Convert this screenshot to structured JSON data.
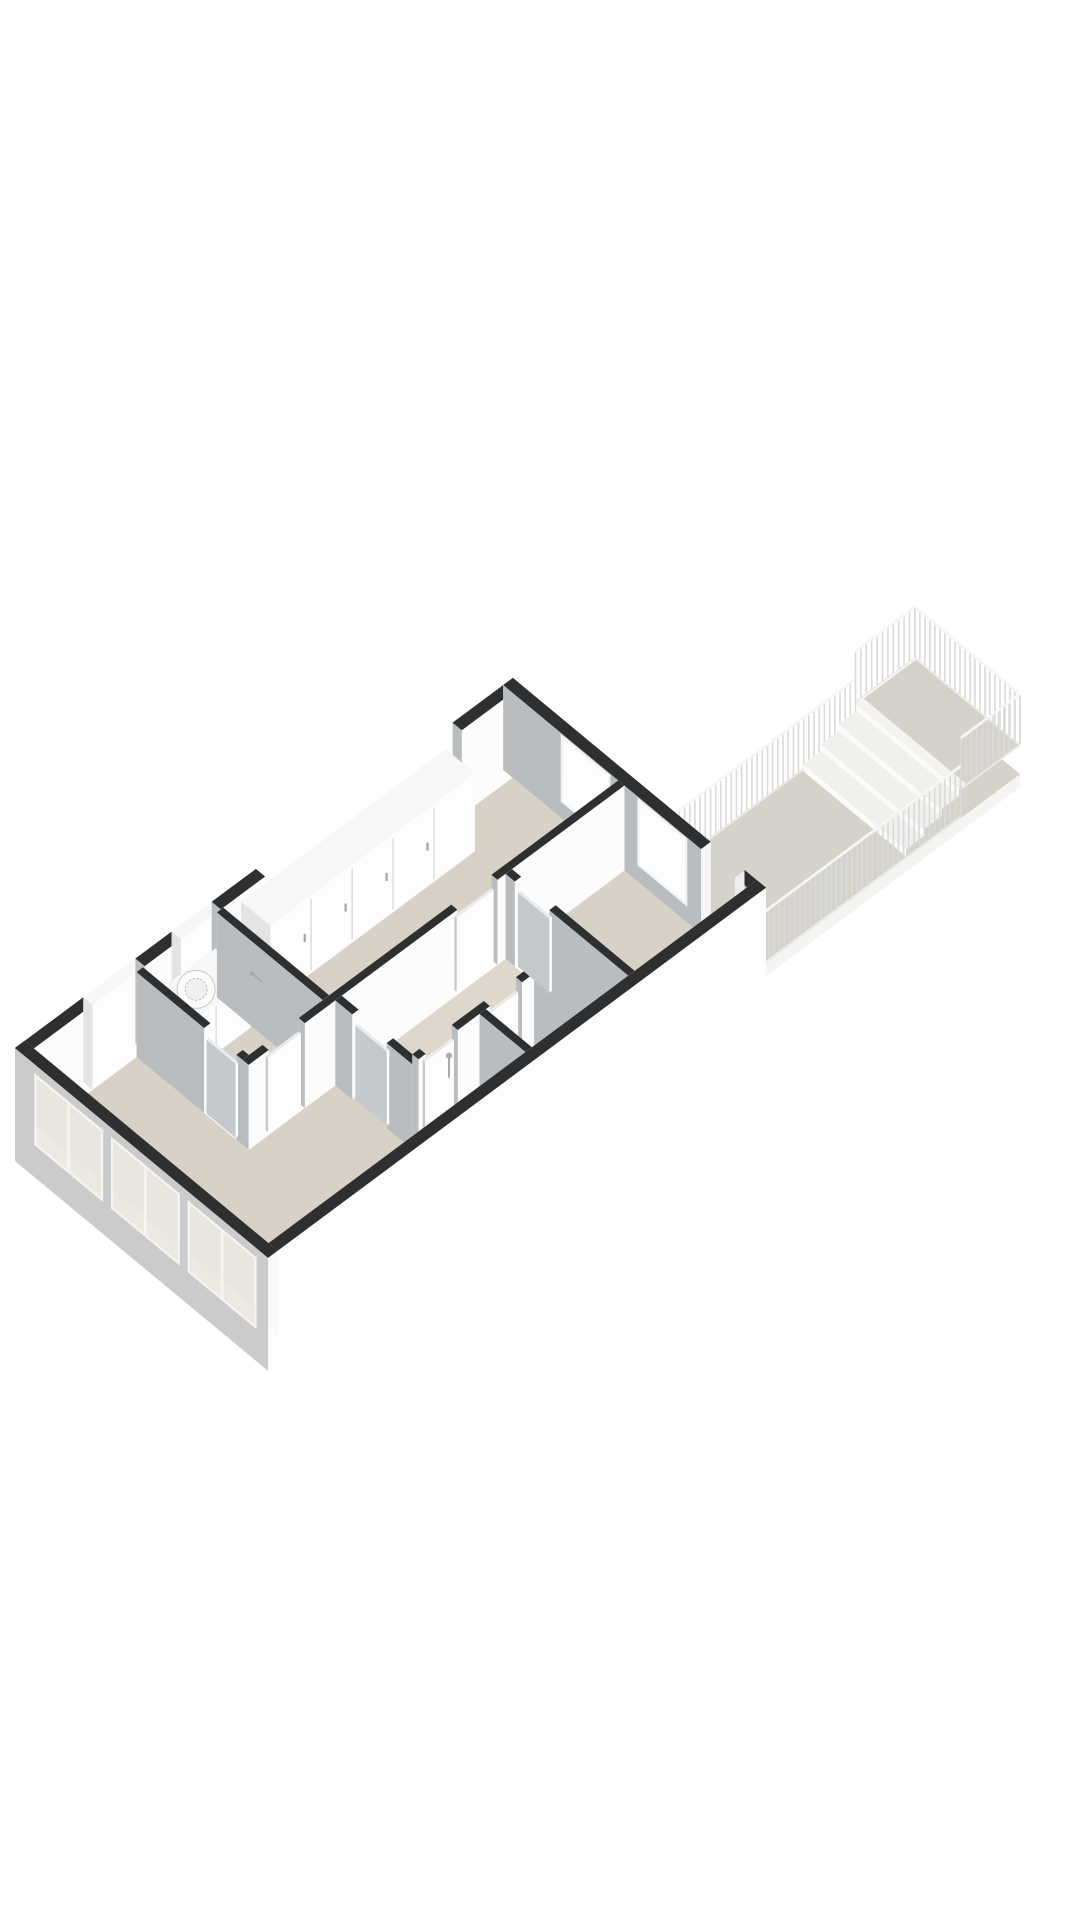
{
  "scene": {
    "type": "3d-floor-plan-render",
    "description": "Axonometric cutaway 3D floor plan of an apartment viewed from the south-west, with dark cut wall tops, beige floors, facade windows, and an exterior access walkway with white baluster railings and three steps up to a raised landing",
    "background": "#ffffff"
  },
  "colors": {
    "wall_top": "#2e2f30",
    "wall_face_sw": "#fcfcfc",
    "wall_face_nw": "#f3f3f2",
    "wall_face_gray": "#b9bdc0",
    "wall_face_ne": "#eaeaec",
    "facade": "#c9cbcc",
    "floor": "#d8d1c5",
    "floor_hall": "#ddd7cc",
    "floor_bath": "#e1ded7",
    "walk_floor": "#d5d2c9",
    "glass": "#e9e6e0",
    "glass_bright": "#fdfdfe",
    "frame": "#f4f4f3",
    "win_panel": "#ece9e2",
    "rail_top": "#f6f6f6",
    "rail_base": "#ebebea",
    "rail_baluster": "#d8dadb",
    "step": "#f1f0ed",
    "riser": "#fbfbfa",
    "top_white": "#f7f7f7",
    "door_top": "#ebebeb",
    "handle": "#a0a4a7",
    "fixture": "#a8abad",
    "slab": "#fdfdfd"
  },
  "building": {
    "name": "apartment",
    "facade_window_count": 3,
    "rear_window_count": 2,
    "rooms": [
      "living-room",
      "kitchen",
      "bedroom-1",
      "bedroom-2",
      "hallway",
      "bathroom",
      "toilet",
      "storage"
    ],
    "fixtures": [
      "washing-machine",
      "kitchen-counter",
      "wardrobe-closets",
      "toilet",
      "shower-fixture",
      "entrance-opening"
    ]
  },
  "walkway": {
    "name": "access-walkway",
    "step_count": 3,
    "railing_style": "white-baluster",
    "sides_with_railing": 3
  }
}
